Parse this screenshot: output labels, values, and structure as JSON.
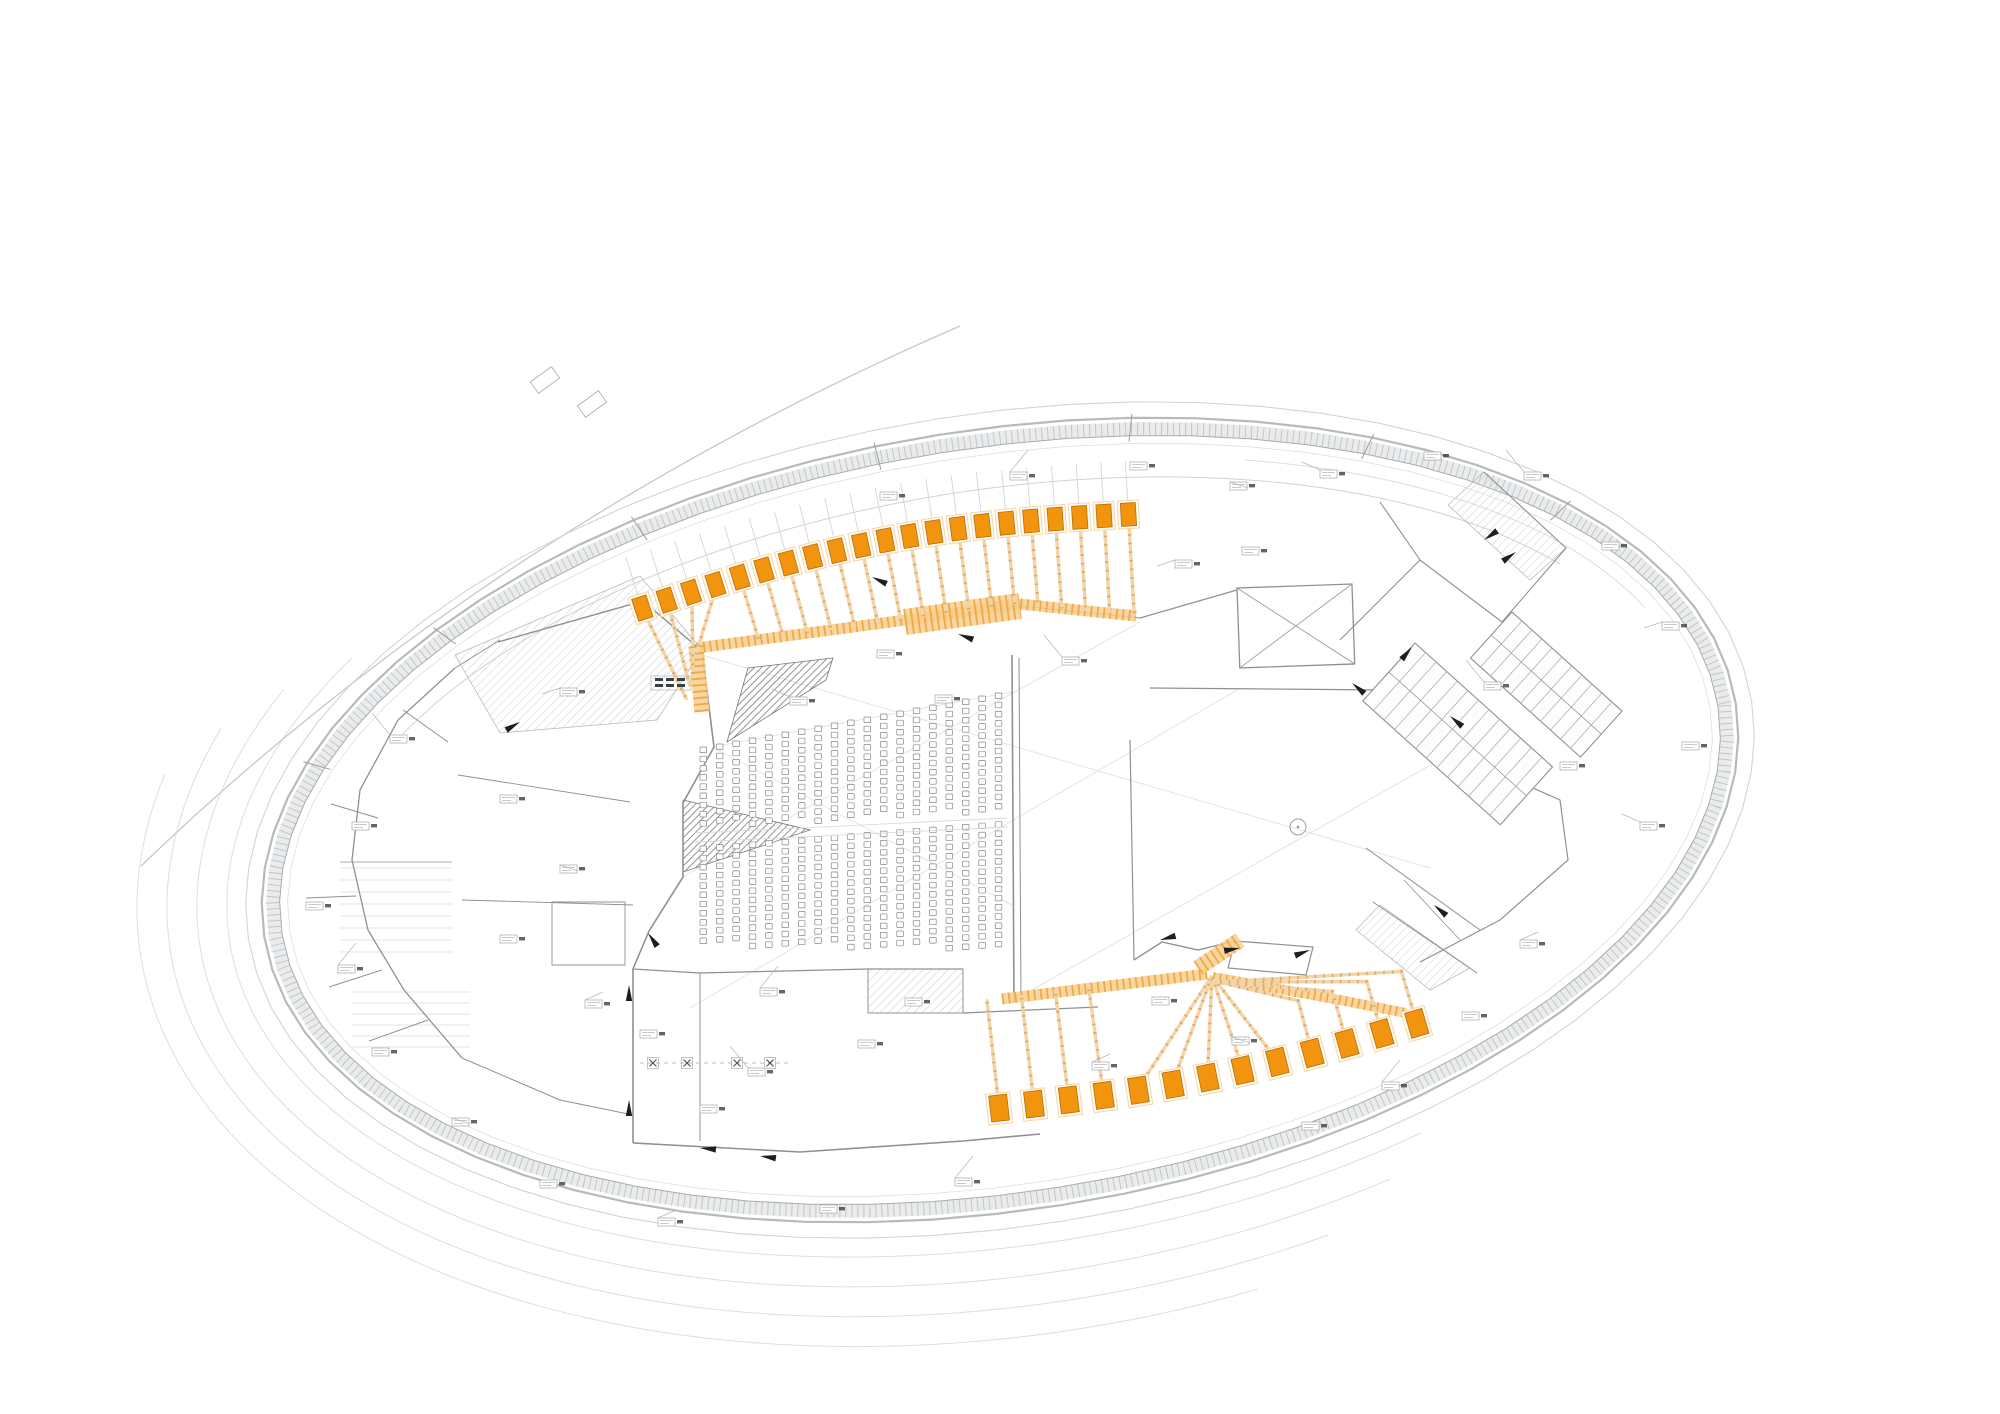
{
  "palette": {
    "background": "#ffffff",
    "orange_beam": "#F2940D",
    "orange_beam_edge": "#B86E06",
    "orange_pad": "#F6D6A6",
    "orange_stem": "#F3D4A8",
    "orange_stem_rung": "#DFA765",
    "orange_band": "#F8CF8F",
    "orange_band_hatch": "#EE9E30",
    "shell_outer": "#B7BABC",
    "shell_site": "#D2D4D6",
    "shell_band_fill": "#E9EBEC",
    "shell_band_hatch": "#C3C6C8",
    "shell_inner": "#A8ABAD",
    "offset_arc": "#DCDEE0",
    "wall": "#8E9194",
    "faint": "#D8DADC",
    "seat": "#85888A",
    "hatch_dark": "#7D838B",
    "hatch_light": "#C9CDD1",
    "annotation": "#A4A7A9",
    "annotation_dark": "#3C3F41",
    "black": "#1C1E20"
  },
  "shell": {
    "cx": 1000,
    "cy": 820,
    "a": 745,
    "b": 390,
    "rot": -9,
    "rings": [
      {
        "d": 16,
        "w": 1.1,
        "colorKey": "shell_site"
      },
      {
        "d": 0,
        "w": 2.2,
        "colorKey": "shell_outer"
      },
      {
        "d": -18,
        "w": 1.0,
        "colorKey": "shell_inner"
      },
      {
        "d": -26,
        "w": 0.8,
        "colorKey": "offset_arc"
      }
    ],
    "band": {
      "d": -11,
      "w": 13
    },
    "inner_gallery_arc": {
      "d": -60,
      "t0": 212,
      "t1": 330,
      "w": 1.0
    },
    "topright_room_arc": {
      "d": -40,
      "t0": 295,
      "t1": 342,
      "w": 0.9
    },
    "offset_arcs": [
      {
        "d": 35,
        "t0": 62,
        "t1": 218
      },
      {
        "d": 65,
        "t0": 66,
        "t1": 212
      },
      {
        "d": 95,
        "t0": 72,
        "t1": 206
      },
      {
        "d": 125,
        "t0": 78,
        "t1": 200
      }
    ],
    "band_ticks": [
      205,
      225,
      245,
      265,
      285,
      305,
      325
    ]
  },
  "tangent": {
    "path": "M141,866 Q490,530 960,326",
    "w": 1.3,
    "boxes": [
      {
        "x": 545,
        "y": 380,
        "rot": -36
      },
      {
        "x": 592,
        "y": 404,
        "rot": -36
      }
    ]
  },
  "beams_top": {
    "count": 21,
    "x0": 640,
    "dx": 488,
    "y0": 601,
    "drop": 94,
    "bulge": 21,
    "w": 15,
    "h": 23,
    "tick_len": 46,
    "trunk_targets": [
      [
        687,
        700
      ],
      [
        690,
        686
      ],
      [
        693,
        670
      ],
      [
        695,
        658
      ]
    ]
  },
  "beams_bottom": {
    "count": 13,
    "x0": 1000,
    "dx": 419,
    "y0": 1116,
    "drop": 85,
    "bulge": 12,
    "w": 18,
    "h": 26,
    "hub": [
      1212,
      976
    ],
    "elbow": 62
  },
  "orange_bands": {
    "gallery": {
      "pts": [
        [
          697,
          648
        ],
        [
          905,
          620
        ],
        [
          1020,
          604
        ],
        [
          1136,
          616
        ]
      ],
      "w": 11
    },
    "gallery_wide": {
      "pts": [
        [
          905,
          622
        ],
        [
          1020,
          606
        ]
      ],
      "w": 26
    },
    "trunk": {
      "pts": [
        [
          696,
          646
        ],
        [
          702,
          712
        ]
      ],
      "w": 15
    },
    "bottom_left": {
      "pts": [
        [
          1002,
          999
        ],
        [
          1207,
          974
        ]
      ],
      "w": 11
    },
    "bottom_right": {
      "pts": [
        [
          1213,
          977
        ],
        [
          1340,
          1000
        ],
        [
          1406,
          1013
        ]
      ],
      "w": 10
    },
    "hub_patch": {
      "pts": [
        [
          1198,
          968
        ],
        [
          1240,
          940
        ]
      ],
      "w": 16
    }
  },
  "gallery_y_nodes": [
    [
      700,
      648
    ],
    [
      905,
      620
    ],
    [
      1020,
      604
    ],
    [
      1136,
      616
    ]
  ],
  "bottom_band_left": {
    "x0": 1002,
    "y0": 999,
    "slope": -0.1256
  },
  "seating": {
    "banks": [
      {
        "name": "upper",
        "x0": 700,
        "pitch": 16.4,
        "cols": 19,
        "topBase": 747,
        "topSlope": -3.0,
        "nBase": 9,
        "nSpan": 4,
        "vpitch": 9.2,
        "sw": 6.6,
        "sh": 5.6
      },
      {
        "name": "lower",
        "x0": 700,
        "pitch": 16.4,
        "cols": 19,
        "topBase": 846,
        "topSlope": -1.35,
        "nBase": 11,
        "nSpan": 3,
        "vpitch": 9.2,
        "sw": 6.6,
        "sh": 5.6
      }
    ],
    "aisle_lines": [
      [
        [
          695,
          833
        ],
        [
          1008,
          818
        ]
      ],
      [
        [
          695,
          842
        ],
        [
          1008,
          827
        ]
      ]
    ]
  },
  "walls": [
    {
      "p": [
        [
          498,
          642
        ],
        [
          643,
          601
        ],
        [
          702,
          651
        ]
      ],
      "w": 1.4
    },
    {
      "p": [
        [
          702,
          651
        ],
        [
          714,
          747
        ],
        [
          683,
          803
        ],
        [
          683,
          877
        ],
        [
          649,
          931
        ],
        [
          633,
          969
        ],
        [
          633,
          1143
        ]
      ],
      "w": 1.6
    },
    {
      "p": [
        [
          633,
          1143
        ],
        [
          800,
          1152
        ],
        [
          963,
          1141
        ],
        [
          1040,
          1134
        ]
      ],
      "w": 1.6
    },
    {
      "p": [
        [
          633,
          969
        ],
        [
          700,
          973
        ],
        [
          868,
          969
        ],
        [
          963,
          969
        ]
      ],
      "w": 1.2
    },
    {
      "p": [
        [
          868,
          969
        ],
        [
          868,
          1013
        ],
        [
          963,
          1013
        ],
        [
          963,
          969
        ]
      ],
      "w": 1.0
    },
    {
      "p": [
        [
          700,
          973
        ],
        [
          700,
          1141
        ]
      ],
      "w": 1.0
    },
    {
      "p": [
        [
          963,
          1013
        ],
        [
          1098,
          1007
        ]
      ],
      "w": 1.2
    },
    {
      "p": [
        [
          1012,
          655
        ],
        [
          1014,
          1002
        ]
      ],
      "w": 1.6
    },
    {
      "p": [
        [
          1019,
          658
        ],
        [
          1021,
          1004
        ]
      ],
      "w": 1.0
    },
    {
      "p": [
        [
          1130,
          740
        ],
        [
          1134,
          960
        ]
      ],
      "w": 1.2
    },
    {
      "p": [
        [
          1134,
          960
        ],
        [
          1162,
          942
        ],
        [
          1198,
          950
        ],
        [
          1235,
          941
        ]
      ],
      "w": 1.4
    },
    {
      "p": [
        [
          1235,
          941
        ],
        [
          1313,
          947
        ],
        [
          1306,
          975
        ],
        [
          1228,
          968
        ],
        [
          1235,
          941
        ]
      ],
      "w": 1.2
    },
    {
      "p": [
        [
          1150,
          688
        ],
        [
          1385,
          690
        ],
        [
          1434,
          712
        ],
        [
          1481,
          765
        ]
      ],
      "w": 1.3
    },
    {
      "p": [
        [
          1481,
          765
        ],
        [
          1560,
          800
        ],
        [
          1568,
          860
        ],
        [
          1500,
          920
        ],
        [
          1420,
          962
        ]
      ],
      "w": 1.2
    },
    {
      "p": [
        [
          1140,
          618
        ],
        [
          1237,
          590
        ]
      ],
      "w": 1.2
    },
    {
      "p": [
        [
          1366,
          848
        ],
        [
          1480,
          930
        ]
      ],
      "w": 1.0
    },
    {
      "p": [
        [
          1340,
          640
        ],
        [
          1420,
          560
        ],
        [
          1502,
          622
        ]
      ],
      "w": 1.1
    },
    {
      "p": [
        [
          1420,
          560
        ],
        [
          1380,
          502
        ]
      ],
      "w": 1.1
    },
    {
      "p": [
        [
          1502,
          622
        ],
        [
          1566,
          548
        ],
        [
          1484,
          472
        ]
      ],
      "w": 1.1
    },
    {
      "p": [
        [
          403,
          710
        ],
        [
          448,
          742
        ]
      ],
      "w": 1.0
    },
    {
      "p": [
        [
          331,
          804
        ],
        [
          378,
          818
        ]
      ],
      "w": 1.0
    },
    {
      "p": [
        [
          306,
          898
        ],
        [
          356,
          896
        ]
      ],
      "w": 1.0
    },
    {
      "p": [
        [
          329,
          987
        ],
        [
          382,
          970
        ]
      ],
      "w": 1.0
    },
    {
      "p": [
        [
          369,
          1041
        ],
        [
          428,
          1020
        ]
      ],
      "w": 1.0
    },
    {
      "p": [
        [
          455,
          668
        ],
        [
          398,
          720
        ],
        [
          360,
          790
        ],
        [
          352,
          860
        ],
        [
          368,
          930
        ],
        [
          404,
          990
        ],
        [
          462,
          1058
        ]
      ],
      "w": 1.3
    },
    {
      "p": [
        [
          462,
          1058
        ],
        [
          560,
          1100
        ],
        [
          633,
          1115
        ]
      ],
      "w": 1.0
    },
    {
      "p": [
        [
          458,
          775
        ],
        [
          630,
          802
        ]
      ],
      "w": 0.9
    },
    {
      "p": [
        [
          462,
          900
        ],
        [
          633,
          905
        ]
      ],
      "w": 0.9
    },
    {
      "p": [
        [
          552,
          902
        ],
        [
          625,
          902
        ],
        [
          625,
          965
        ],
        [
          552,
          965
        ],
        [
          552,
          902
        ]
      ],
      "w": 0.9
    },
    {
      "p": [
        [
          500,
          640
        ],
        [
          455,
          668
        ]
      ],
      "w": 1.0
    },
    {
      "p": [
        [
          340,
          862
        ],
        [
          452,
          862
        ]
      ],
      "w": 0.8
    },
    {
      "p": [
        [
          1373,
          902
        ],
        [
          1477,
          973
        ]
      ],
      "w": 1.0
    },
    {
      "p": [
        [
          1404,
          880
        ],
        [
          1460,
          940
        ]
      ],
      "w": 0.8
    },
    {
      "p": [
        [
          905,
          622
        ],
        [
          1020,
          606
        ],
        [
          1140,
          618
        ]
      ],
      "w": 1.1
    }
  ],
  "faint_lines": [
    [
      [
        702,
        655
      ],
      [
        1430,
        868
      ]
    ],
    [
      [
        690,
        1008
      ],
      [
        1237,
        690
      ]
    ],
    [
      [
        683,
        877
      ],
      [
        1140,
        622
      ]
    ],
    [
      [
        1014,
        1000
      ],
      [
        1436,
        762
      ]
    ],
    [
      [
        712,
        747
      ],
      [
        1012,
        692
      ]
    ],
    [
      [
        712,
        747
      ],
      [
        1012,
        905
      ]
    ]
  ],
  "shelf_lines": {
    "groups": [
      {
        "x0": 340,
        "x1": 452,
        "y0": 868,
        "step": 12,
        "n": 8
      },
      {
        "x0": 352,
        "x1": 470,
        "y0": 992,
        "step": 11,
        "n": 6
      }
    ]
  },
  "hatch_zones": [
    {
      "pts": [
        [
          455,
          655
        ],
        [
          640,
          576
        ],
        [
          702,
          650
        ],
        [
          657,
          720
        ],
        [
          500,
          733
        ]
      ],
      "pat": "light"
    },
    {
      "pts": [
        [
          727,
          742
        ],
        [
          748,
          668
        ],
        [
          833,
          658
        ],
        [
          826,
          680
        ]
      ],
      "pat": "dark"
    },
    {
      "pts": [
        [
          683,
          800
        ],
        [
          810,
          830
        ],
        [
          683,
          872
        ]
      ],
      "pat": "dark"
    },
    {
      "pts": [
        [
          868,
          969
        ],
        [
          963,
          969
        ],
        [
          963,
          1013
        ],
        [
          868,
          1013
        ]
      ],
      "pat": "light"
    },
    {
      "pts": [
        [
          1380,
          905
        ],
        [
          1470,
          968
        ],
        [
          1430,
          990
        ],
        [
          1356,
          930
        ]
      ],
      "pat": "light"
    },
    {
      "pts": [
        [
          1484,
          472
        ],
        [
          1566,
          548
        ],
        [
          1530,
          580
        ],
        [
          1448,
          505
        ]
      ],
      "pat": "light"
    }
  ],
  "stairs": [
    {
      "x": 1415,
      "y": 643,
      "rot": 42,
      "w": 185,
      "h": 78,
      "steps": 13
    },
    {
      "x": 1512,
      "y": 612,
      "rot": 42,
      "w": 148,
      "h": 62,
      "steps": 11
    }
  ],
  "xrooms": [
    {
      "x": 1237,
      "y": 588,
      "w": 115,
      "h": 80,
      "rot": -2
    }
  ],
  "circles": [
    {
      "x": 1298,
      "y": 827,
      "r": 8
    }
  ],
  "xmarks": {
    "y": 1063,
    "xs": [
      653,
      687,
      737,
      770
    ],
    "size": 7,
    "dash_line": [
      [
        640,
        1063
      ],
      [
        790,
        1063
      ]
    ]
  },
  "wedges": [
    [
      629,
      985,
      90
    ],
    [
      629,
      1100,
      90
    ],
    [
      648,
      933,
      55
    ],
    [
      1160,
      940,
      -15
    ],
    [
      1240,
      948,
      170
    ],
    [
      1352,
      683,
      40
    ],
    [
      1412,
      647,
      130
    ],
    [
      1450,
      716,
      40
    ],
    [
      872,
      577,
      25
    ],
    [
      958,
      634,
      20
    ],
    [
      1484,
      540,
      -35
    ],
    [
      1516,
      552,
      145
    ],
    [
      760,
      1156,
      8
    ],
    [
      1310,
      950,
      160
    ],
    [
      1434,
      905,
      40
    ],
    [
      520,
      722,
      150
    ],
    [
      700,
      1148,
      5
    ]
  ],
  "annotations": [
    [
      390,
      735,
      1
    ],
    [
      352,
      822,
      0
    ],
    [
      306,
      902,
      0
    ],
    [
      338,
      965,
      1
    ],
    [
      372,
      1048,
      0
    ],
    [
      452,
      1118,
      1
    ],
    [
      540,
      1180,
      0
    ],
    [
      658,
      1218,
      1
    ],
    [
      820,
      1205,
      0
    ],
    [
      955,
      1178,
      1
    ],
    [
      500,
      795,
      0
    ],
    [
      560,
      865,
      1
    ],
    [
      500,
      935,
      0
    ],
    [
      585,
      1000,
      1
    ],
    [
      640,
      1030,
      0
    ],
    [
      760,
      988,
      1
    ],
    [
      858,
      1040,
      0
    ],
    [
      905,
      998,
      0
    ],
    [
      748,
      1068,
      1
    ],
    [
      700,
      1105,
      0
    ],
    [
      560,
      688,
      1
    ],
    [
      655,
      682,
      2
    ],
    [
      790,
      697,
      1
    ],
    [
      935,
      695,
      0
    ],
    [
      1062,
      657,
      1
    ],
    [
      877,
      650,
      0
    ],
    [
      1175,
      560,
      1
    ],
    [
      1242,
      547,
      0
    ],
    [
      1320,
      470,
      1
    ],
    [
      1424,
      452,
      0
    ],
    [
      1524,
      472,
      1
    ],
    [
      1602,
      542,
      0
    ],
    [
      1662,
      622,
      1
    ],
    [
      1682,
      742,
      0
    ],
    [
      1640,
      822,
      1
    ],
    [
      1560,
      762,
      0
    ],
    [
      1484,
      682,
      1
    ],
    [
      1520,
      940,
      1
    ],
    [
      1462,
      1012,
      0
    ],
    [
      1382,
      1082,
      1
    ],
    [
      1302,
      1122,
      0
    ],
    [
      1232,
      1037,
      1
    ],
    [
      1152,
      997,
      0
    ],
    [
      1092,
      1062,
      1
    ],
    [
      1130,
      462,
      0
    ],
    [
      1010,
      472,
      1
    ],
    [
      880,
      492,
      0
    ],
    [
      1230,
      482,
      1
    ]
  ]
}
